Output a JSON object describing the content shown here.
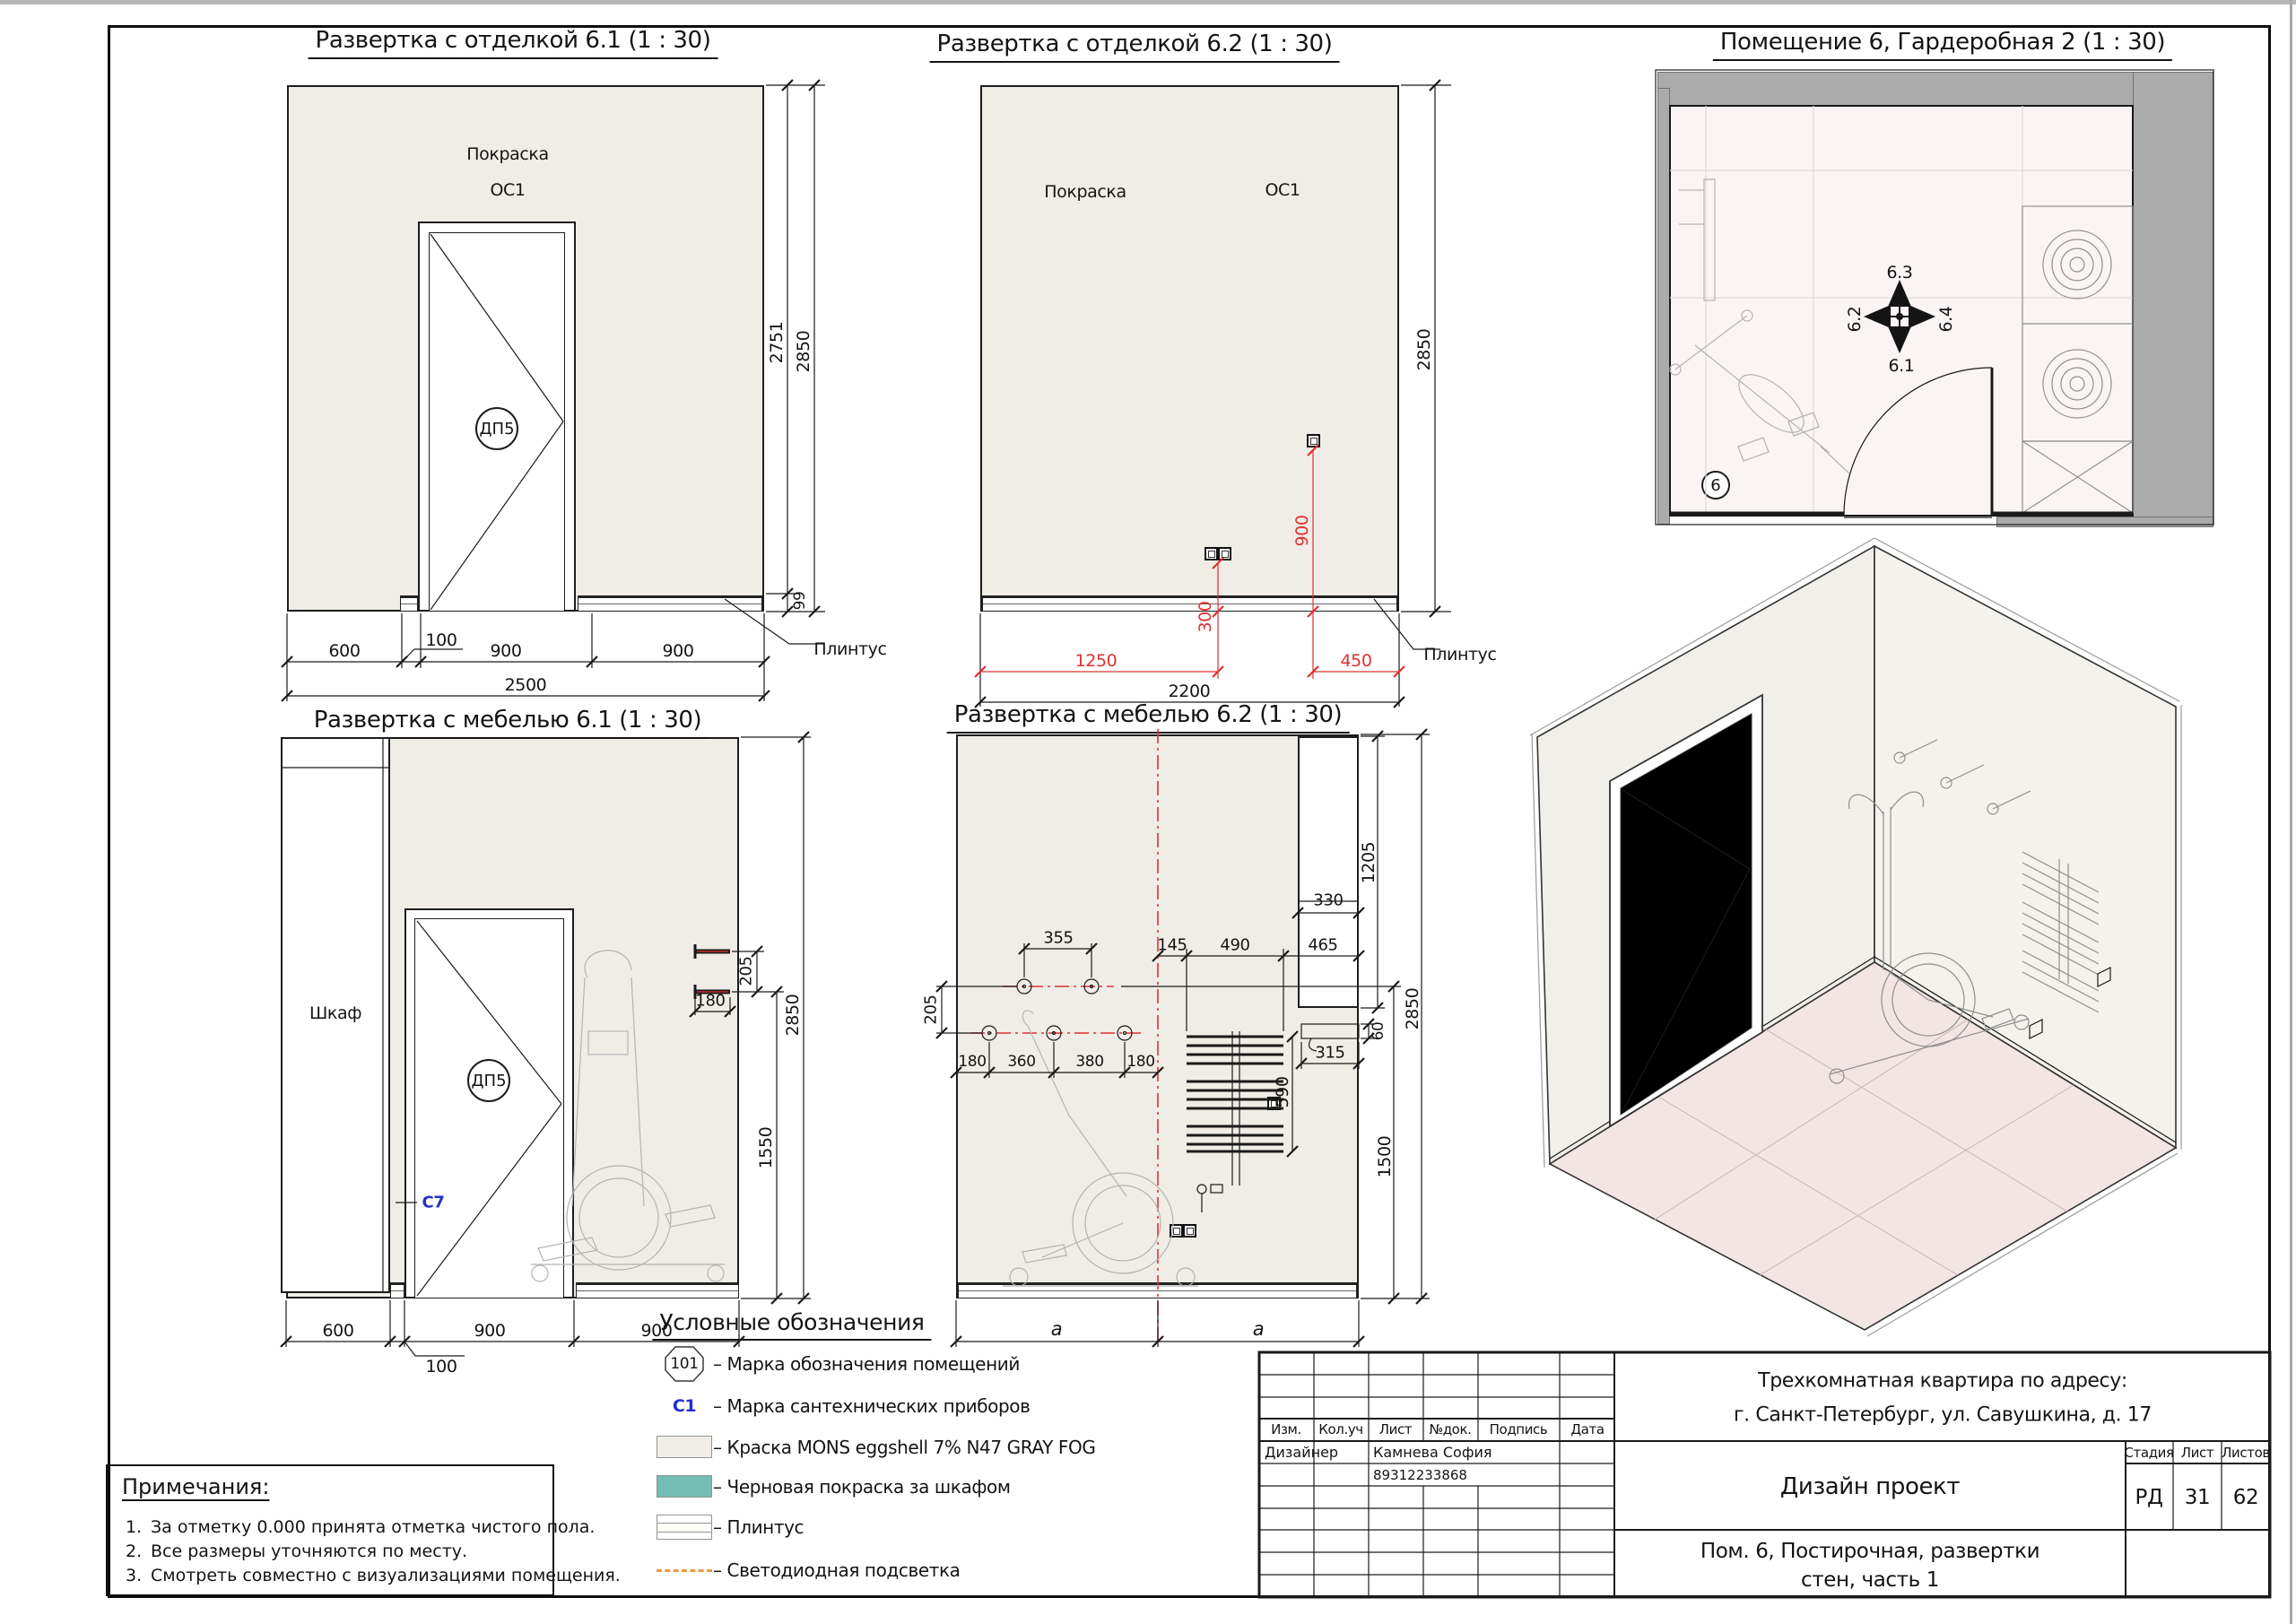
{
  "colors": {
    "wall_fill": "#f0ede7",
    "rough_paint_teal": "#74bdb4",
    "dim_red": "#e03030",
    "marker_blue": "#2230d0",
    "led_orange": "#eb9d3f"
  },
  "finish61": {
    "title": "Развертка с отделкой 6.1 (1 : 30)",
    "paint": "Покраска",
    "paint_code": "ОС1",
    "door_mark": "ДП5",
    "plinth": "Плинтус",
    "dim_600": "600",
    "dim_100": "100",
    "dim_900a": "900",
    "dim_900b": "900",
    "dim_total": "2500",
    "dim_2751": "2751",
    "dim_2850": "2850",
    "dim_99": "99"
  },
  "finish62": {
    "title": "Развертка с отделкой 6.2 (1 : 30)",
    "paint": "Покраска",
    "paint_code": "ОС1",
    "plinth": "Плинтус",
    "dim_300": "300",
    "dim_900": "900",
    "dim_1250": "1250",
    "dim_450": "450",
    "dim_total": "2200",
    "dim_2850": "2850"
  },
  "plan6": {
    "title": "Помещение 6, Гардеробная 2 (1 : 30)",
    "room_no": "6",
    "dir_up": "6.3",
    "dir_down": "6.1",
    "dir_left": "6.2",
    "dir_right": "6.4"
  },
  "furn61": {
    "title": "Развертка с мебелью 6.1 (1 : 30)",
    "wardrobe": "Шкаф",
    "door_mark": "ДП5",
    "marker_c7": "С7",
    "dim_600": "600",
    "dim_900a": "900",
    "dim_900b": "900",
    "dim_100": "100",
    "dim_205": "205",
    "dim_180": "180",
    "dim_1550": "1550",
    "dim_2850": "2850"
  },
  "furn62": {
    "title": "Развертка с мебелью 6.2 (1 : 30)",
    "dim_355": "355",
    "dim_205": "205",
    "dim_row": [
      "180",
      "360",
      "380",
      "180"
    ],
    "dim_145": "145",
    "dim_490": "490",
    "dim_465": "465",
    "dim_330": "330",
    "dim_1205": "1205",
    "dim_315": "315",
    "dim_60": "60",
    "dim_590": "590",
    "dim_1500": "1500",
    "dim_2850": "2850",
    "dim_a_left": "a",
    "dim_a_right": "a"
  },
  "legend": {
    "heading": "Условные обозначения",
    "room_mark": "101",
    "san_mark": "С1",
    "items": [
      "– Марка обозначения помещений",
      "– Марка сантехнических приборов",
      "– Краска MONS eggshell 7% N47 GRAY FOG",
      "– Черновая покраска за шкафом",
      "– Плинтус",
      "– Светодиодная подсветка"
    ]
  },
  "notes": {
    "heading": "Примечания:",
    "items": [
      {
        "n": "1.",
        "text": "За отметку 0.000 принята отметка чистого пола."
      },
      {
        "n": "2.",
        "text": "Все размеры уточняются по месту."
      },
      {
        "n": "3.",
        "text": "Смотреть совместно с визуализациями помещения."
      }
    ]
  },
  "titleblock": {
    "col_izm": "Изм.",
    "col_koluch": "Кол.уч",
    "col_list": "Лист",
    "col_dok": "№док.",
    "col_podpis": "Подпись",
    "col_data": "Дата",
    "designer_role": "Дизайнер",
    "designer_name": "Камнева София",
    "designer_phone": "89312233868",
    "address_line1": "Трехкомнатная квартира по адресу:",
    "address_line2": "г. Санкт-Петербург, ул. Савушкина, д. 17",
    "project": "Дизайн проект",
    "stage_label": "Стадия",
    "sheet_label": "Лист",
    "sheets_label": "Листов",
    "stage": "РД",
    "sheet_no": "31",
    "sheets_total": "62",
    "subject_line1": "Пом. 6, Постирочная, развертки",
    "subject_line2": "стен, часть 1"
  }
}
